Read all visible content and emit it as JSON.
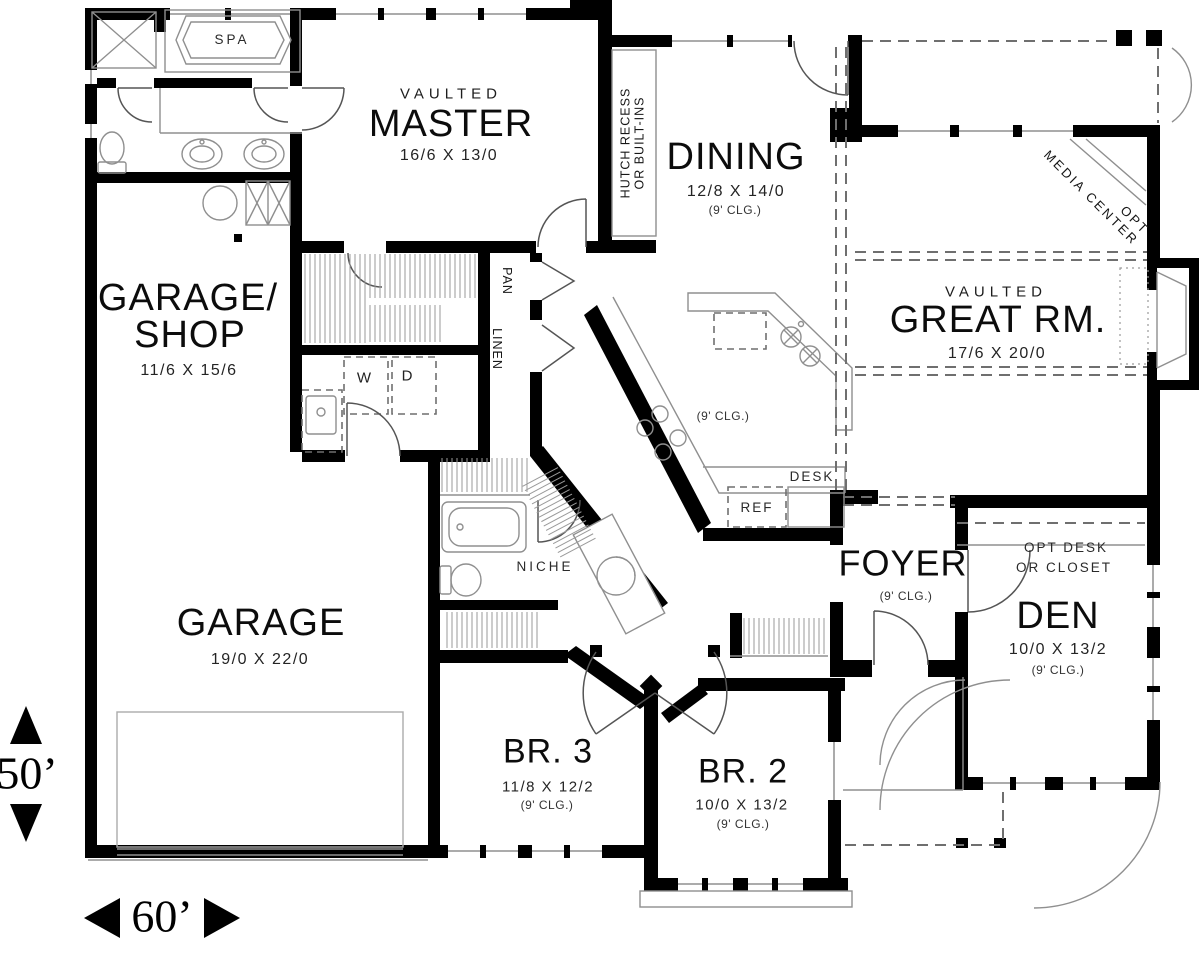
{
  "plan": {
    "rooms": {
      "master": {
        "tag": "VAULTED",
        "name": "MASTER",
        "dims": "16/6 X 13/0"
      },
      "dining": {
        "name": "DINING",
        "dims": "12/8 X 14/0",
        "ceiling": "(9' CLG.)"
      },
      "great_room": {
        "tag": "VAULTED",
        "name": "GREAT RM.",
        "dims": "17/6 X 20/0"
      },
      "garage_shop": {
        "name_line_1": "GARAGE/",
        "name_line_2": "SHOP",
        "dims": "11/6 X 15/6"
      },
      "garage": {
        "name": "GARAGE",
        "dims": "19/0 X 22/0"
      },
      "kitchen": {
        "ceiling": "(9' CLG.)"
      },
      "foyer": {
        "name": "FOYER",
        "ceiling": "(9' CLG.)"
      },
      "den": {
        "name": "DEN",
        "dims": "10/0 X 13/2",
        "ceiling": "(9' CLG.)"
      },
      "bedroom_3": {
        "name": "BR. 3",
        "dims": "11/8 X 12/2",
        "ceiling": "(9' CLG.)"
      },
      "bedroom_2": {
        "name": "BR. 2",
        "dims": "10/0 X 13/2",
        "ceiling": "(9' CLG.)"
      }
    },
    "callouts": {
      "spa": "SPA",
      "pantry": "PAN",
      "linen": "LINEN",
      "washer": "W",
      "dryer": "D",
      "desk": "DESK",
      "refrigerator": "REF",
      "niche": "NICHE",
      "hutch_line_1": "HUTCH RECESS",
      "hutch_line_2": "OR BUILT-INS",
      "media_line_1": "OPT",
      "media_line_2": "MEDIA CENTER",
      "opt_desk_line_1": "OPT DESK",
      "opt_desk_line_2": "OR CLOSET"
    },
    "lot_dimensions": {
      "depth": "50’",
      "width": "60’"
    },
    "colors": {
      "background": "#ffffff",
      "walls": "#000000",
      "text": "#161616",
      "thin_lines": "#8f8f8f",
      "dashed_lines": "#6f6f6f"
    }
  }
}
